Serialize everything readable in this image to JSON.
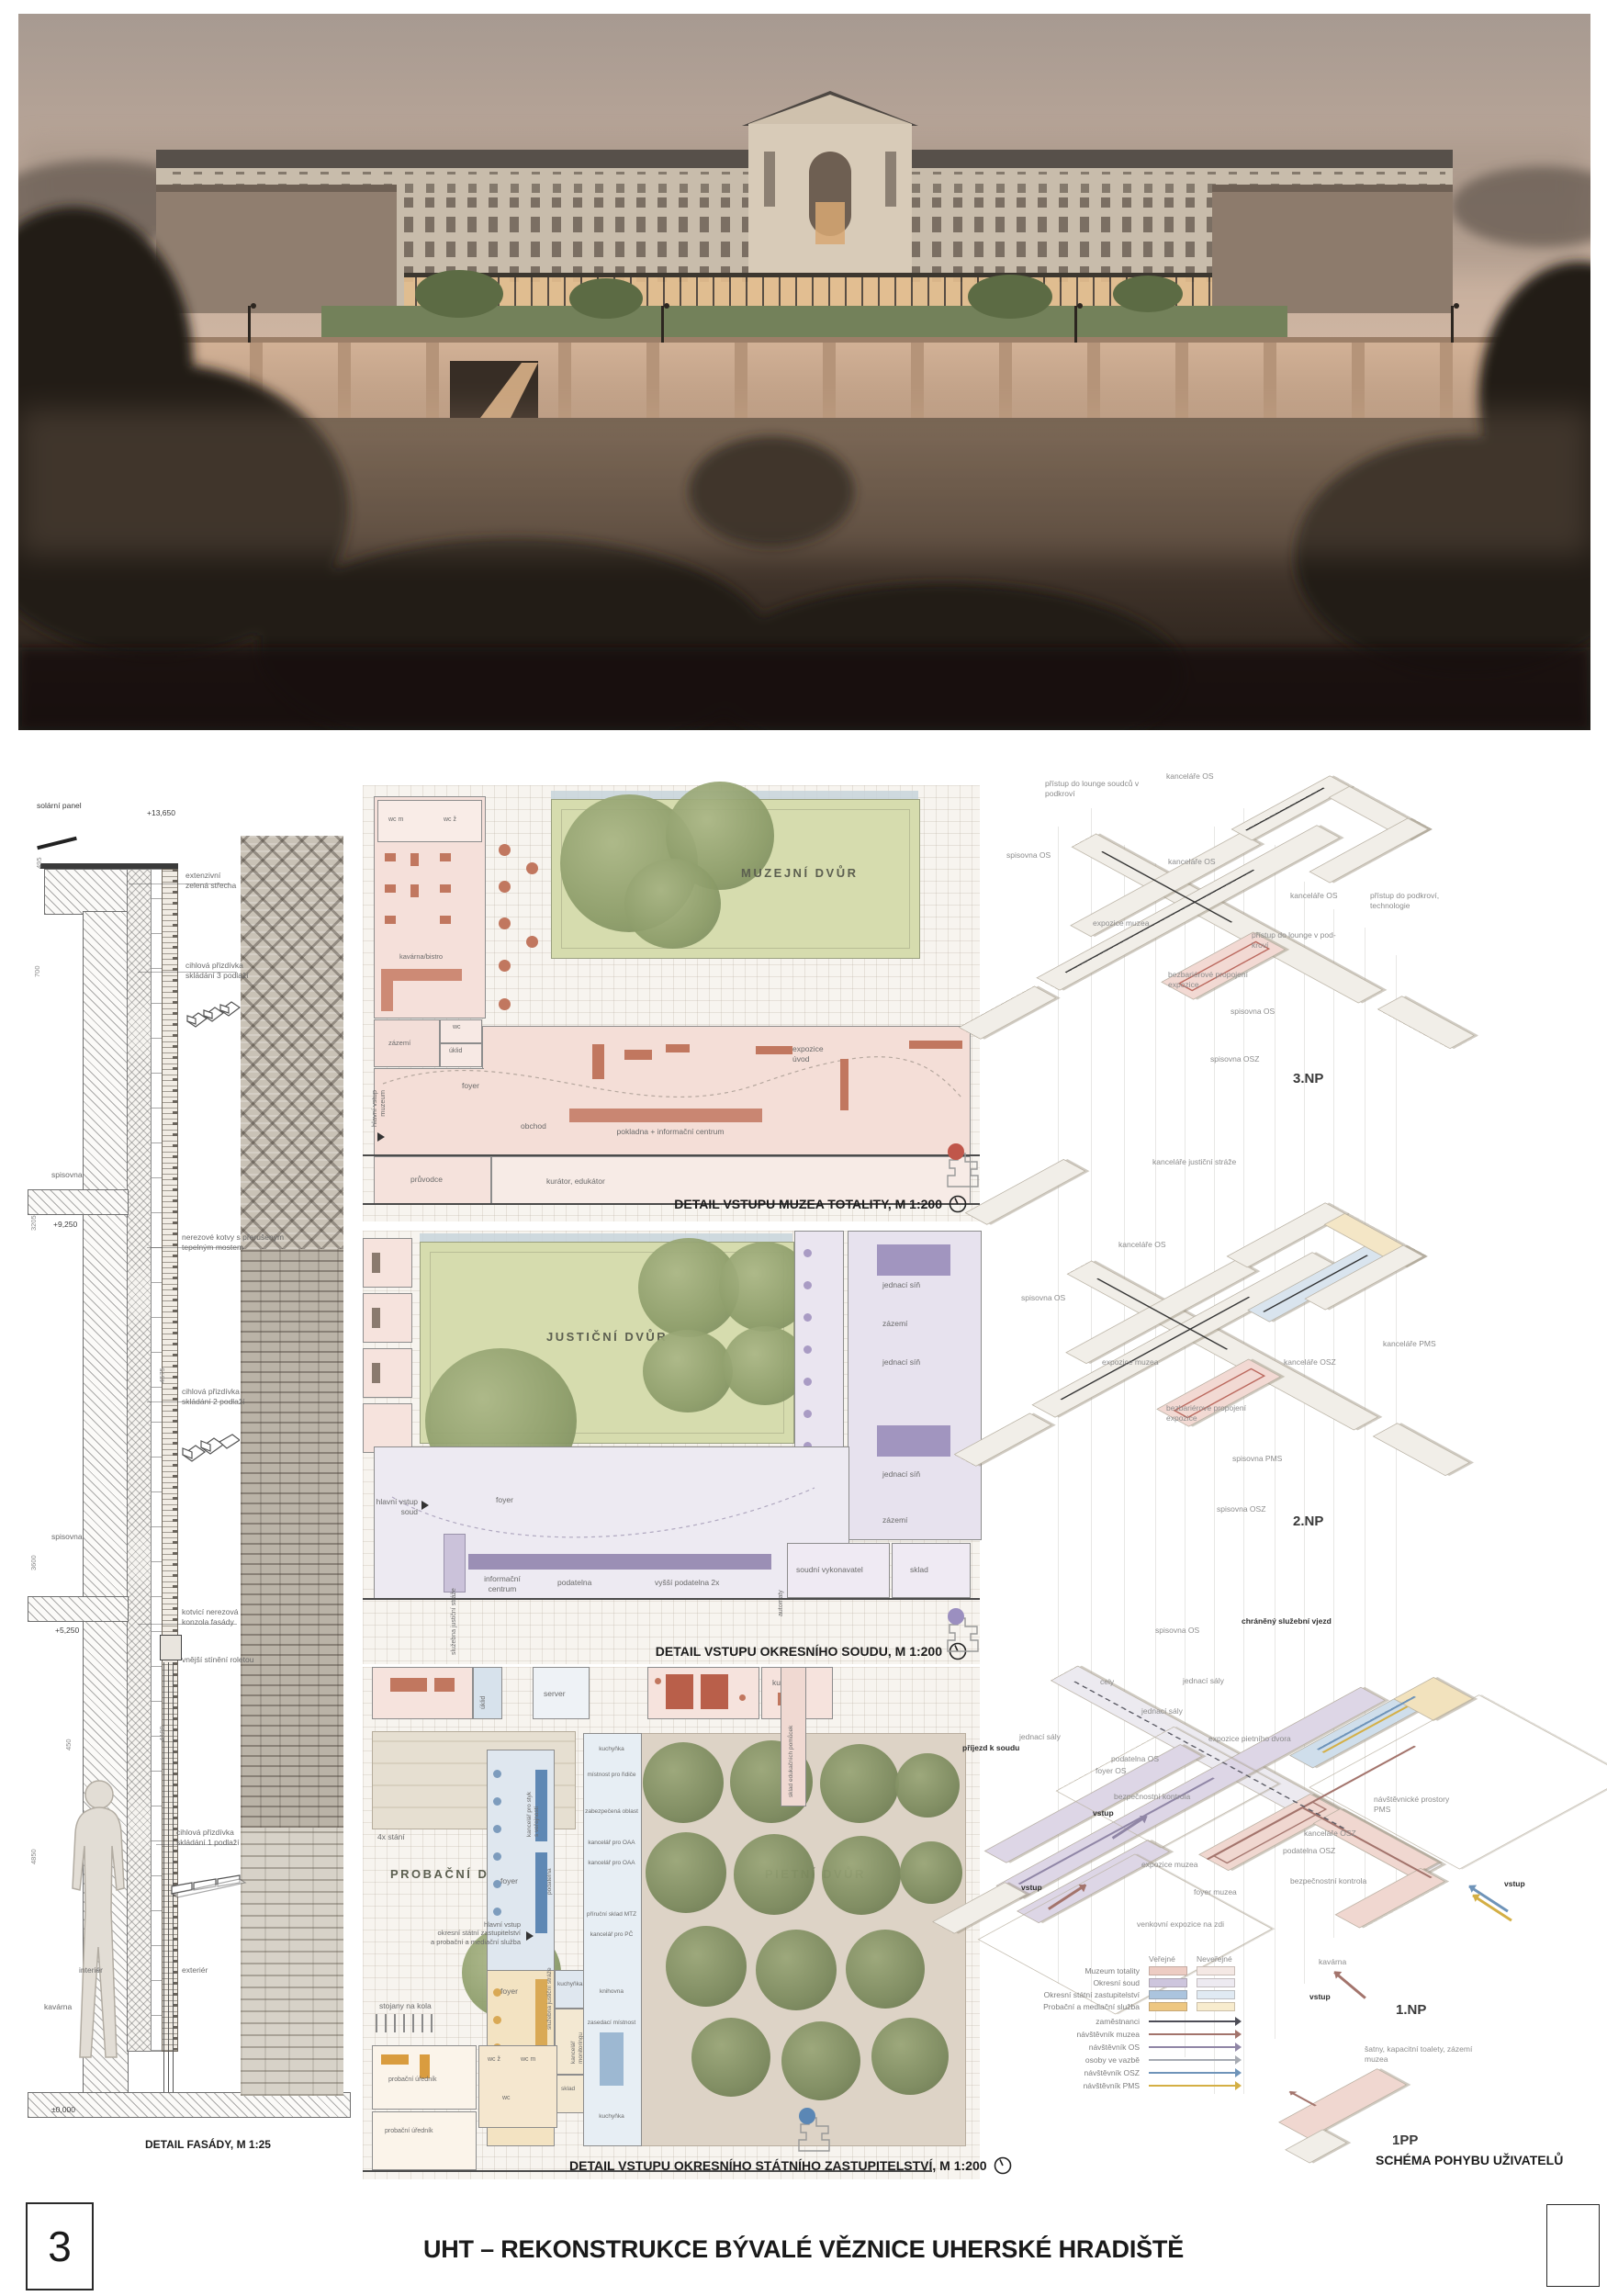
{
  "footer": {
    "page_number": "3",
    "title": "UHT – REKONSTRUKCE BÝVALÉ VĚZNICE UHERSKÉ HRADIŠTĚ"
  },
  "facade": {
    "caption": "DETAIL FASÁDY, M 1:25",
    "labels": [
      "solární panel",
      "+13,650",
      "extenzivní\nzelená střecha",
      "cihlová přizdívka\nskládání 3 podlaží",
      "spisovna",
      "+9,250",
      "nerezové kotvy s přerušeným\ntepelným mostem",
      "cihlová přizdívka\nskládání 2 podlaží",
      "spisovna",
      "+5,250",
      "kotvicí nerezová\nkonzola fasády",
      "vnější stínění roletou",
      "cihlová přizdívka\nskládání 1 podlaží",
      "interiér",
      "exteriér",
      "kavárna",
      "±0,000"
    ],
    "dims": [
      "495",
      "700",
      "3205",
      "450",
      "3600",
      "4575",
      "4850",
      "4100"
    ]
  },
  "plan1": {
    "caption": "DETAIL VSTUPU MUZEA TOTALITY, M 1:200",
    "courtyard": "MUZEJNÍ DVŮR",
    "labels": [
      "wc m",
      "wc ž",
      "kavárna/bistro",
      "zázemí",
      "wc",
      "úklid",
      "foyer",
      "obchod",
      "pokladna + informační centrum",
      "expozice\núvod",
      "průvodce",
      "kurátor, edukátor"
    ],
    "entrance": "hlavní vstup\nmuzeum"
  },
  "plan2": {
    "caption": "DETAIL VSTUPU OKRESNÍHO SOUDU, M 1:200",
    "courtyard": "JUSTIČNÍ DVŮR",
    "labels": [
      "jednací síň",
      "zázemí",
      "jednací síň",
      "jednací síň",
      "zázemí",
      "lounge",
      "foyer",
      "informační\ncentrum",
      "podatelna",
      "vyšší podatelna 2x",
      "soudní vykonavatel",
      "sklad",
      "služebna justiční stráže",
      "automaty"
    ],
    "entrance": "hlavní vstup\nsoud"
  },
  "plan3": {
    "caption": "DETAIL VSTUPU OKRESNÍHO STÁTNÍHO ZASTUPITELSTVÍ, M 1:200",
    "courtyard_a": "PROBAČNÍ DVŮR",
    "courtyard_b": "PIETNÍ DVŮR",
    "labels": [
      "úklid",
      "server",
      "kuchyňka",
      "sklad edukačních pomůcek",
      "4x stání",
      "stojany na kola",
      "foyer",
      "kancelář pro styk\ns veřejností",
      "podatelna",
      "služebna justiční stráže",
      "foyer",
      "kuchyňka",
      "kancelář\nmonitoringu",
      "sklad",
      "kuchyňka",
      "místnost pro řidiče",
      "zabezpečená oblast",
      "kancelář pro OAA",
      "kancelář pro OAA",
      "příruční sklad MTZ",
      "kancelář pro PČ",
      "knihovna",
      "zasedací místnost",
      "kuchyňka",
      "probační úředník",
      "wc ž",
      "wc m",
      "wc",
      "probační úředník"
    ],
    "entrance": "hlavní vstup\nokresní státní zastupitelství\na probační a mediační služba"
  },
  "axon3np": {
    "floor": "3.NP",
    "labels": [
      "přístup do lounge soudců v\npodkroví",
      "kanceláře OS",
      "spisovna OS",
      "kanceláře OS",
      "expozice muzea",
      "kanceláře OS",
      "přístup do podkroví,\ntechnologie",
      "přístup do lounge v pod-\nkroví",
      "bezbariérové propojení\nexpozice",
      "spisovna OS",
      "spisovna OSZ"
    ]
  },
  "axon2np": {
    "floor": "2.NP",
    "labels": [
      "kanceláře justiční stráže",
      "kanceláře OS",
      "spisovna OS",
      "expozice muzea",
      "kanceláře OSZ",
      "kanceláře PMS",
      "bezbariérové propojení\nexpozice",
      "spisovna PMS",
      "spisovna OSZ"
    ]
  },
  "axon1np": {
    "floor": "1.NP",
    "vstup": "vstup",
    "labels": [
      "chráněný služební vjezd",
      "spisovna OS",
      "cely",
      "jednací sály",
      "jednací sály",
      "jednací sály",
      "expozice pietního dvora",
      "příjezd k soudu",
      "podatelna OS",
      "foyer OS",
      "bezpečnostní kontrola",
      "návštěvnické prostory\nPMS",
      "kanceláře OSZ",
      "podatelna OSZ",
      "expozice muzea",
      "bezpečnostní kontrola",
      "foyer muzea",
      "venkovní expozice na zdi",
      "kavárna"
    ]
  },
  "axon1pp": {
    "floor": "1PP",
    "labels": [
      "šatny, kapacitní toalety, zázemí\nmuzea"
    ]
  },
  "legend": {
    "public": "Veřejné",
    "private": "Neveřejné",
    "programs": [
      {
        "name": "Muzeum totality",
        "pub": "#edccc3",
        "priv": "#f4e8e4"
      },
      {
        "name": "Okresní soud",
        "pub": "#cdc5dd",
        "priv": "#edeaf1"
      },
      {
        "name": "Okresní státní zastupitelství",
        "pub": "#abc4de",
        "priv": "#e0eaf3"
      },
      {
        "name": "Probační a mediační služba",
        "pub": "#eec781",
        "priv": "#f8ecce"
      }
    ],
    "flows": [
      {
        "name": "zaměstnanci",
        "color": "#4d4d57"
      },
      {
        "name": "návštěvník muzea",
        "color": "#a3746c"
      },
      {
        "name": "návštěvník OS",
        "color": "#9086a6"
      },
      {
        "name": "osoby ve vazbě",
        "color": "#a6aab2"
      },
      {
        "name": "návštěvník OSZ",
        "color": "#6f94b9"
      },
      {
        "name": "návštěvník PMS",
        "color": "#d4af45"
      }
    ]
  },
  "schema_caption": "SCHÉMA POHYBU UŽIVATELŮ"
}
